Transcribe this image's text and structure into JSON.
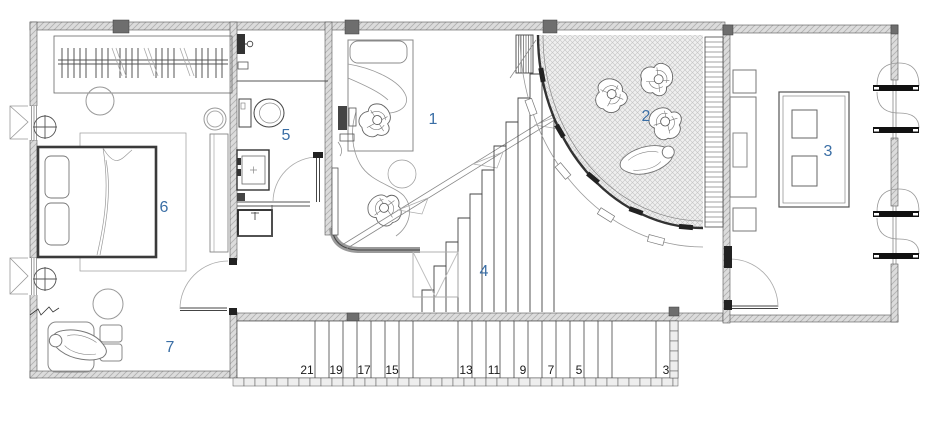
{
  "plan": {
    "rooms": [
      {
        "number": "1"
      },
      {
        "number": "2"
      },
      {
        "number": "3"
      },
      {
        "number": "4"
      },
      {
        "number": "5"
      },
      {
        "number": "6"
      },
      {
        "number": "7"
      }
    ],
    "stair": {
      "steps": [
        "21",
        "19",
        "17",
        "15",
        "13",
        "11",
        "9",
        "7",
        "5",
        "3"
      ]
    },
    "colors": {
      "room_label": "#3a6ea5",
      "stair_label": "#1a1a1a",
      "wall_fill": "#dcdcdc",
      "wall_hatch_line": "#b0b0b0",
      "column_fill": "#6e6e6e",
      "terrace_fill": "#efefef",
      "terrace_hatch_line": "#c4c4c4",
      "line_dark": "#3c3c3c",
      "line_light": "#9a9a9a"
    }
  }
}
